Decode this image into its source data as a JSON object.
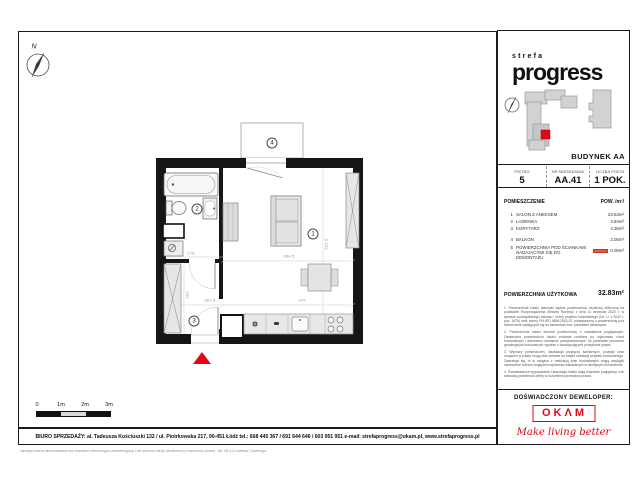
{
  "north": {
    "label": "N"
  },
  "scalebar": {
    "labels": [
      "0",
      "1m",
      "2m",
      "3m"
    ]
  },
  "plan": {
    "markers": [
      {
        "n": "1"
      },
      {
        "n": "2"
      },
      {
        "n": "3"
      },
      {
        "n": "4"
      }
    ],
    "dims": {
      "salon_width": "454.5",
      "salon_height": "515.5",
      "kitchen_width": "379",
      "hall_width": "261.5",
      "hall_height": "202",
      "bath_width": "176"
    }
  },
  "sidebar": {
    "brand": {
      "top": "strefa",
      "bottom": "progress"
    },
    "building_label": "BUDYNEK AA",
    "unit_info": {
      "floor": {
        "label": "PIĘTRO",
        "value": "5"
      },
      "number": {
        "label": "NR MIESZKANIA",
        "value": "AA.41"
      },
      "rooms_count": {
        "label": "LICZBA POKOI",
        "value": "1 POK."
      }
    },
    "room_table": {
      "header_name": "POMIESZCZENIE",
      "header_area": "POW. /m²/",
      "rows": [
        {
          "no": "1",
          "name": "SALON Z ANEKSEM",
          "area": "23.63m²"
        },
        {
          "no": "2",
          "name": "ŁAZIENKA",
          "area": "4.84m²"
        },
        {
          "no": "3",
          "name": "KORYTARZ",
          "area": "4.36m²"
        },
        {
          "no": "4",
          "name": "BALKON",
          "area": "2.05m²"
        },
        {
          "no": "5",
          "name": "POWIERZCHNIA POD ŚCIANKAMI NADAJĄCYMI SIĘ DO DEMONTAŻU",
          "area": "0.00m²"
        }
      ]
    },
    "total": {
      "label": "POWIERZCHNIA UŻYTKOWA",
      "value": "32.83m²"
    },
    "disclaimer": [
      "1. Powierzchnia lokalu stanowić będzie powierzchnię użytkową obliczoną na podstawie Rozporządzenia Ministra Rozwoju z dnia 11 września 2020 r. w sprawie szczegółowego zakresu i formy projektu budowlanego (Dz. U. z 2022 r. poz. 1679) oraz normy PN-ISO 9836:2015-07, powiększoną o powierzchnię pod elementami nadającymi się do demontażu tzw. ściankami działowymi.",
      "2. Powierzchnia lokalu stanowi powierzchnię o charakterze poglądowym. Ostateczna powierzchnia lokalu zostanie ustalona po wykonaniu robót budowlanych i dokonaniu obmiarów powykonawczych na podstawie pomiarów geodezyjnych dokonanych zgodnie z obowiązującymi przepisami prawa.",
      "3. Wymiary pomieszczeń, lokalizacja przyłączy sanitarnych, podejść oraz urządzeń w lokalu mogą ulec zmianie na etapie realizacji projektu budowlanego. Zastrzega się, iż w związku z realizacją prac budowlanych mogą wystąpić nieznaczne różnice względem wymiarów wskazanych w niniejszym dokumencie.",
      "4. Przedstawione wyposażenie i aranżacja lokalu mają charakter poglądowy i nie stanowią przedmiotu oferty w rozumieniu przepisów prawa."
    ],
    "developer": {
      "label": "DOŚWIADCZONY DEWELOPER:",
      "logo": "OKΛM",
      "tagline": "Make living better"
    }
  },
  "footer": {
    "sales": "BIURO SPRZEDAŻY: al. Tadeusza Kościuszki 132 / ul. Piotrkowska 217, 90-451 Łódź tel.: 668 445 367 / 691 644 646 / 603 951 951 e-mail: strefaprogress@okam.pl, www.strefaprogress.pl",
    "legal": "Niniejsza karta mieszkaniowa ma charakter informacyjno-marketingowy i nie stanowi oferty handlowej w rozumieniu prawa - Art. 66 §1 Kodeksu Cywilnego."
  },
  "colors": {
    "accent_red": "#e30613",
    "wall": "#161616"
  }
}
